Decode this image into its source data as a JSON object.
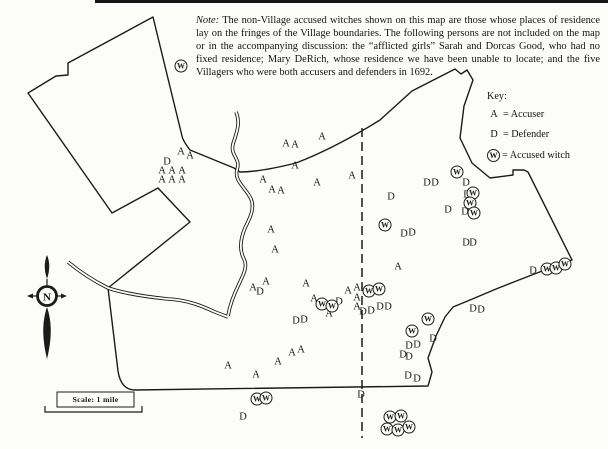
{
  "note": {
    "label": "Note:",
    "body": "The non-Village accused witches shown on this map are those whose places of residence lay on the fringes of the Village boundaries. The following persons are not included on the map or in the accompanying discussion: the “afflicted girls” Sarah and Dorcas Good, who had no fixed residence; Mary DeRich, whose residence we have been unable to locate; and the five Villagers who were both accusers and defenders in 1692."
  },
  "key": {
    "title": "Key:",
    "items": [
      {
        "symbol": "A",
        "label": "= Accuser",
        "circled": false
      },
      {
        "symbol": "D",
        "label": "= Defender",
        "circled": false
      },
      {
        "symbol": "W",
        "label": "= Accused witch",
        "circled": true
      }
    ]
  },
  "compass": {
    "north_label": "N"
  },
  "scale_bar": {
    "label": "Scale: 1 mile"
  },
  "map": {
    "ink_color": "#1b1b1b",
    "paper_color": "#fcfcf9",
    "markers": [
      {
        "t": "A",
        "x": 181,
        "y": 152
      },
      {
        "t": "A",
        "x": 190,
        "y": 156
      },
      {
        "t": "A",
        "x": 162,
        "y": 171
      },
      {
        "t": "A",
        "x": 172,
        "y": 171
      },
      {
        "t": "A",
        "x": 182,
        "y": 171
      },
      {
        "t": "A",
        "x": 162,
        "y": 180
      },
      {
        "t": "A",
        "x": 172,
        "y": 180
      },
      {
        "t": "A",
        "x": 182,
        "y": 180
      },
      {
        "t": "A",
        "x": 286,
        "y": 144
      },
      {
        "t": "A",
        "x": 295,
        "y": 145
      },
      {
        "t": "A",
        "x": 322,
        "y": 137
      },
      {
        "t": "A",
        "x": 295,
        "y": 166
      },
      {
        "t": "A",
        "x": 317,
        "y": 183
      },
      {
        "t": "A",
        "x": 352,
        "y": 176
      },
      {
        "t": "A",
        "x": 263,
        "y": 180
      },
      {
        "t": "A",
        "x": 272,
        "y": 190
      },
      {
        "t": "A",
        "x": 281,
        "y": 191
      },
      {
        "t": "A",
        "x": 271,
        "y": 230
      },
      {
        "t": "A",
        "x": 275,
        "y": 250
      },
      {
        "t": "A",
        "x": 266,
        "y": 282
      },
      {
        "t": "A",
        "x": 253,
        "y": 288
      },
      {
        "t": "A",
        "x": 306,
        "y": 284
      },
      {
        "t": "A",
        "x": 314,
        "y": 299
      },
      {
        "t": "A",
        "x": 329,
        "y": 314
      },
      {
        "t": "A",
        "x": 348,
        "y": 291
      },
      {
        "t": "A",
        "x": 357,
        "y": 288
      },
      {
        "t": "A",
        "x": 357,
        "y": 298
      },
      {
        "t": "A",
        "x": 357,
        "y": 307
      },
      {
        "t": "A",
        "x": 398,
        "y": 267
      },
      {
        "t": "A",
        "x": 228,
        "y": 366
      },
      {
        "t": "A",
        "x": 256,
        "y": 375
      },
      {
        "t": "A",
        "x": 278,
        "y": 362
      },
      {
        "t": "A",
        "x": 292,
        "y": 353
      },
      {
        "t": "A",
        "x": 301,
        "y": 350
      },
      {
        "t": "D",
        "x": 167,
        "y": 162
      },
      {
        "t": "D",
        "x": 260,
        "y": 292
      },
      {
        "t": "D",
        "x": 339,
        "y": 302
      },
      {
        "t": "D",
        "x": 363,
        "y": 312
      },
      {
        "t": "D",
        "x": 371,
        "y": 311
      },
      {
        "t": "D",
        "x": 380,
        "y": 307
      },
      {
        "t": "D",
        "x": 388,
        "y": 307
      },
      {
        "t": "D",
        "x": 296,
        "y": 321
      },
      {
        "t": "D",
        "x": 304,
        "y": 320
      },
      {
        "t": "D",
        "x": 427,
        "y": 183
      },
      {
        "t": "D",
        "x": 435,
        "y": 183
      },
      {
        "t": "D",
        "x": 466,
        "y": 183
      },
      {
        "t": "D",
        "x": 391,
        "y": 197
      },
      {
        "t": "D",
        "x": 467,
        "y": 195
      },
      {
        "t": "D",
        "x": 448,
        "y": 210
      },
      {
        "t": "D",
        "x": 465,
        "y": 212
      },
      {
        "t": "D",
        "x": 404,
        "y": 234
      },
      {
        "t": "D",
        "x": 412,
        "y": 233
      },
      {
        "t": "D",
        "x": 466,
        "y": 243
      },
      {
        "t": "D",
        "x": 473,
        "y": 243
      },
      {
        "t": "D",
        "x": 473,
        "y": 309
      },
      {
        "t": "D",
        "x": 481,
        "y": 310
      },
      {
        "t": "D",
        "x": 433,
        "y": 339
      },
      {
        "t": "D",
        "x": 409,
        "y": 346
      },
      {
        "t": "D",
        "x": 417,
        "y": 345
      },
      {
        "t": "D",
        "x": 403,
        "y": 355
      },
      {
        "t": "D",
        "x": 409,
        "y": 357
      },
      {
        "t": "D",
        "x": 408,
        "y": 376
      },
      {
        "t": "D",
        "x": 417,
        "y": 379
      },
      {
        "t": "D",
        "x": 533,
        "y": 271
      },
      {
        "t": "D",
        "x": 243,
        "y": 417
      },
      {
        "t": "D",
        "x": 361,
        "y": 395
      },
      {
        "t": "W",
        "x": 181,
        "y": 66
      },
      {
        "t": "W",
        "x": 457,
        "y": 172
      },
      {
        "t": "W",
        "x": 473,
        "y": 193
      },
      {
        "t": "W",
        "x": 470,
        "y": 203
      },
      {
        "t": "W",
        "x": 474,
        "y": 213
      },
      {
        "t": "W",
        "x": 385,
        "y": 225
      },
      {
        "t": "W",
        "x": 369,
        "y": 291
      },
      {
        "t": "W",
        "x": 379,
        "y": 289
      },
      {
        "t": "W",
        "x": 322,
        "y": 304
      },
      {
        "t": "W",
        "x": 332,
        "y": 306
      },
      {
        "t": "W",
        "x": 412,
        "y": 331
      },
      {
        "t": "W",
        "x": 428,
        "y": 319
      },
      {
        "t": "W",
        "x": 547,
        "y": 269
      },
      {
        "t": "W",
        "x": 556,
        "y": 268
      },
      {
        "t": "W",
        "x": 565,
        "y": 264
      },
      {
        "t": "W",
        "x": 257,
        "y": 399
      },
      {
        "t": "W",
        "x": 266,
        "y": 398
      },
      {
        "t": "W",
        "x": 390,
        "y": 417
      },
      {
        "t": "W",
        "x": 401,
        "y": 416
      },
      {
        "t": "W",
        "x": 387,
        "y": 429
      },
      {
        "t": "W",
        "x": 398,
        "y": 430
      },
      {
        "t": "W",
        "x": 409,
        "y": 427
      }
    ]
  }
}
